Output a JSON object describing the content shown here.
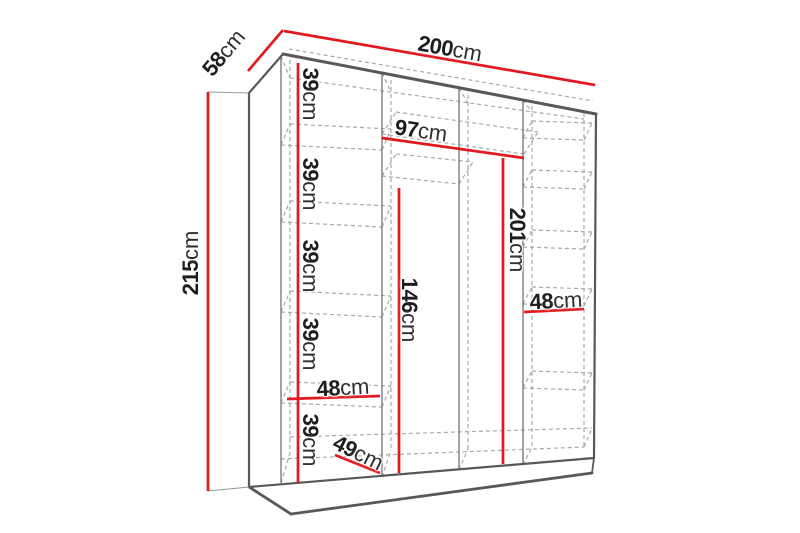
{
  "diagram": {
    "type": "wardrobe-dimension-diagram",
    "unit": "cm",
    "labels": {
      "depth": {
        "value": "58",
        "unit": "cm"
      },
      "width": {
        "value": "200",
        "unit": "cm"
      },
      "height": {
        "value": "215",
        "unit": "cm"
      },
      "shelf_gap_1": {
        "value": "39",
        "unit": "cm"
      },
      "shelf_gap_2": {
        "value": "39",
        "unit": "cm"
      },
      "shelf_gap_3": {
        "value": "39",
        "unit": "cm"
      },
      "shelf_gap_4": {
        "value": "39",
        "unit": "cm"
      },
      "shelf_gap_5": {
        "value": "39",
        "unit": "cm"
      },
      "middle_section_width": {
        "value": "97",
        "unit": "cm"
      },
      "right_hanging_height": {
        "value": "201",
        "unit": "cm"
      },
      "left_hanging_height": {
        "value": "146",
        "unit": "cm"
      },
      "left_column_width": {
        "value": "48",
        "unit": "cm"
      },
      "right_column_width": {
        "value": "48",
        "unit": "cm"
      },
      "base_depth": {
        "value": "49",
        "unit": "cm"
      }
    },
    "colors": {
      "dimension_line": "#e21a20",
      "outline": "#57585a",
      "partition": "#7b7c7f",
      "dashed": "#a6a8ab",
      "text": "#1d1d1f",
      "background": "#ffffff"
    }
  }
}
